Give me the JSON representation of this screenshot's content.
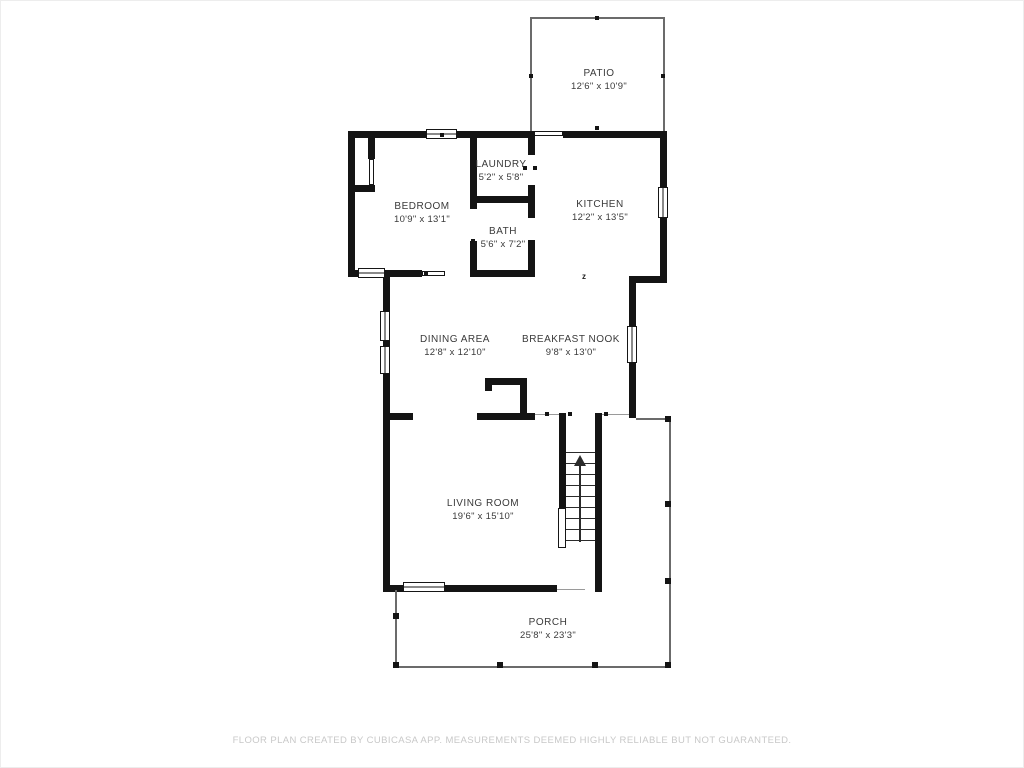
{
  "page": {
    "background_color": "#ffffff",
    "wall_color": "#141414",
    "label_color": "#3a3a3a",
    "footer_color": "#c8c8c8"
  },
  "rooms": [
    {
      "id": "patio",
      "name": "PATIO",
      "dims": "12'6\" x 10'9\""
    },
    {
      "id": "laundry",
      "name": "LAUNDRY",
      "dims": "5'2\" x 5'8\""
    },
    {
      "id": "bedroom",
      "name": "BEDROOM",
      "dims": "10'9\" x 13'1\""
    },
    {
      "id": "kitchen",
      "name": "KITCHEN",
      "dims": "12'2\" x 13'5\""
    },
    {
      "id": "bath",
      "name": "BATH",
      "dims": "5'6\" x 7'2\""
    },
    {
      "id": "dining-area",
      "name": "DINING AREA",
      "dims": "12'8\" x 12'10\""
    },
    {
      "id": "breakfast-nook",
      "name": "BREAKFAST NOOK",
      "dims": "9'8\" x 13'0\""
    },
    {
      "id": "living-room",
      "name": "LIVING ROOM",
      "dims": "19'6\" x 15'10\""
    },
    {
      "id": "porch",
      "name": "PORCH",
      "dims": "25'8\" x 23'3\""
    }
  ],
  "symbols": {
    "z_marker": "z",
    "stair_direction": "up"
  },
  "footer": {
    "disclaimer": "FLOOR PLAN CREATED BY CUBICASA APP. MEASUREMENTS DEEMED HIGHLY RELIABLE BUT NOT GUARANTEED."
  }
}
